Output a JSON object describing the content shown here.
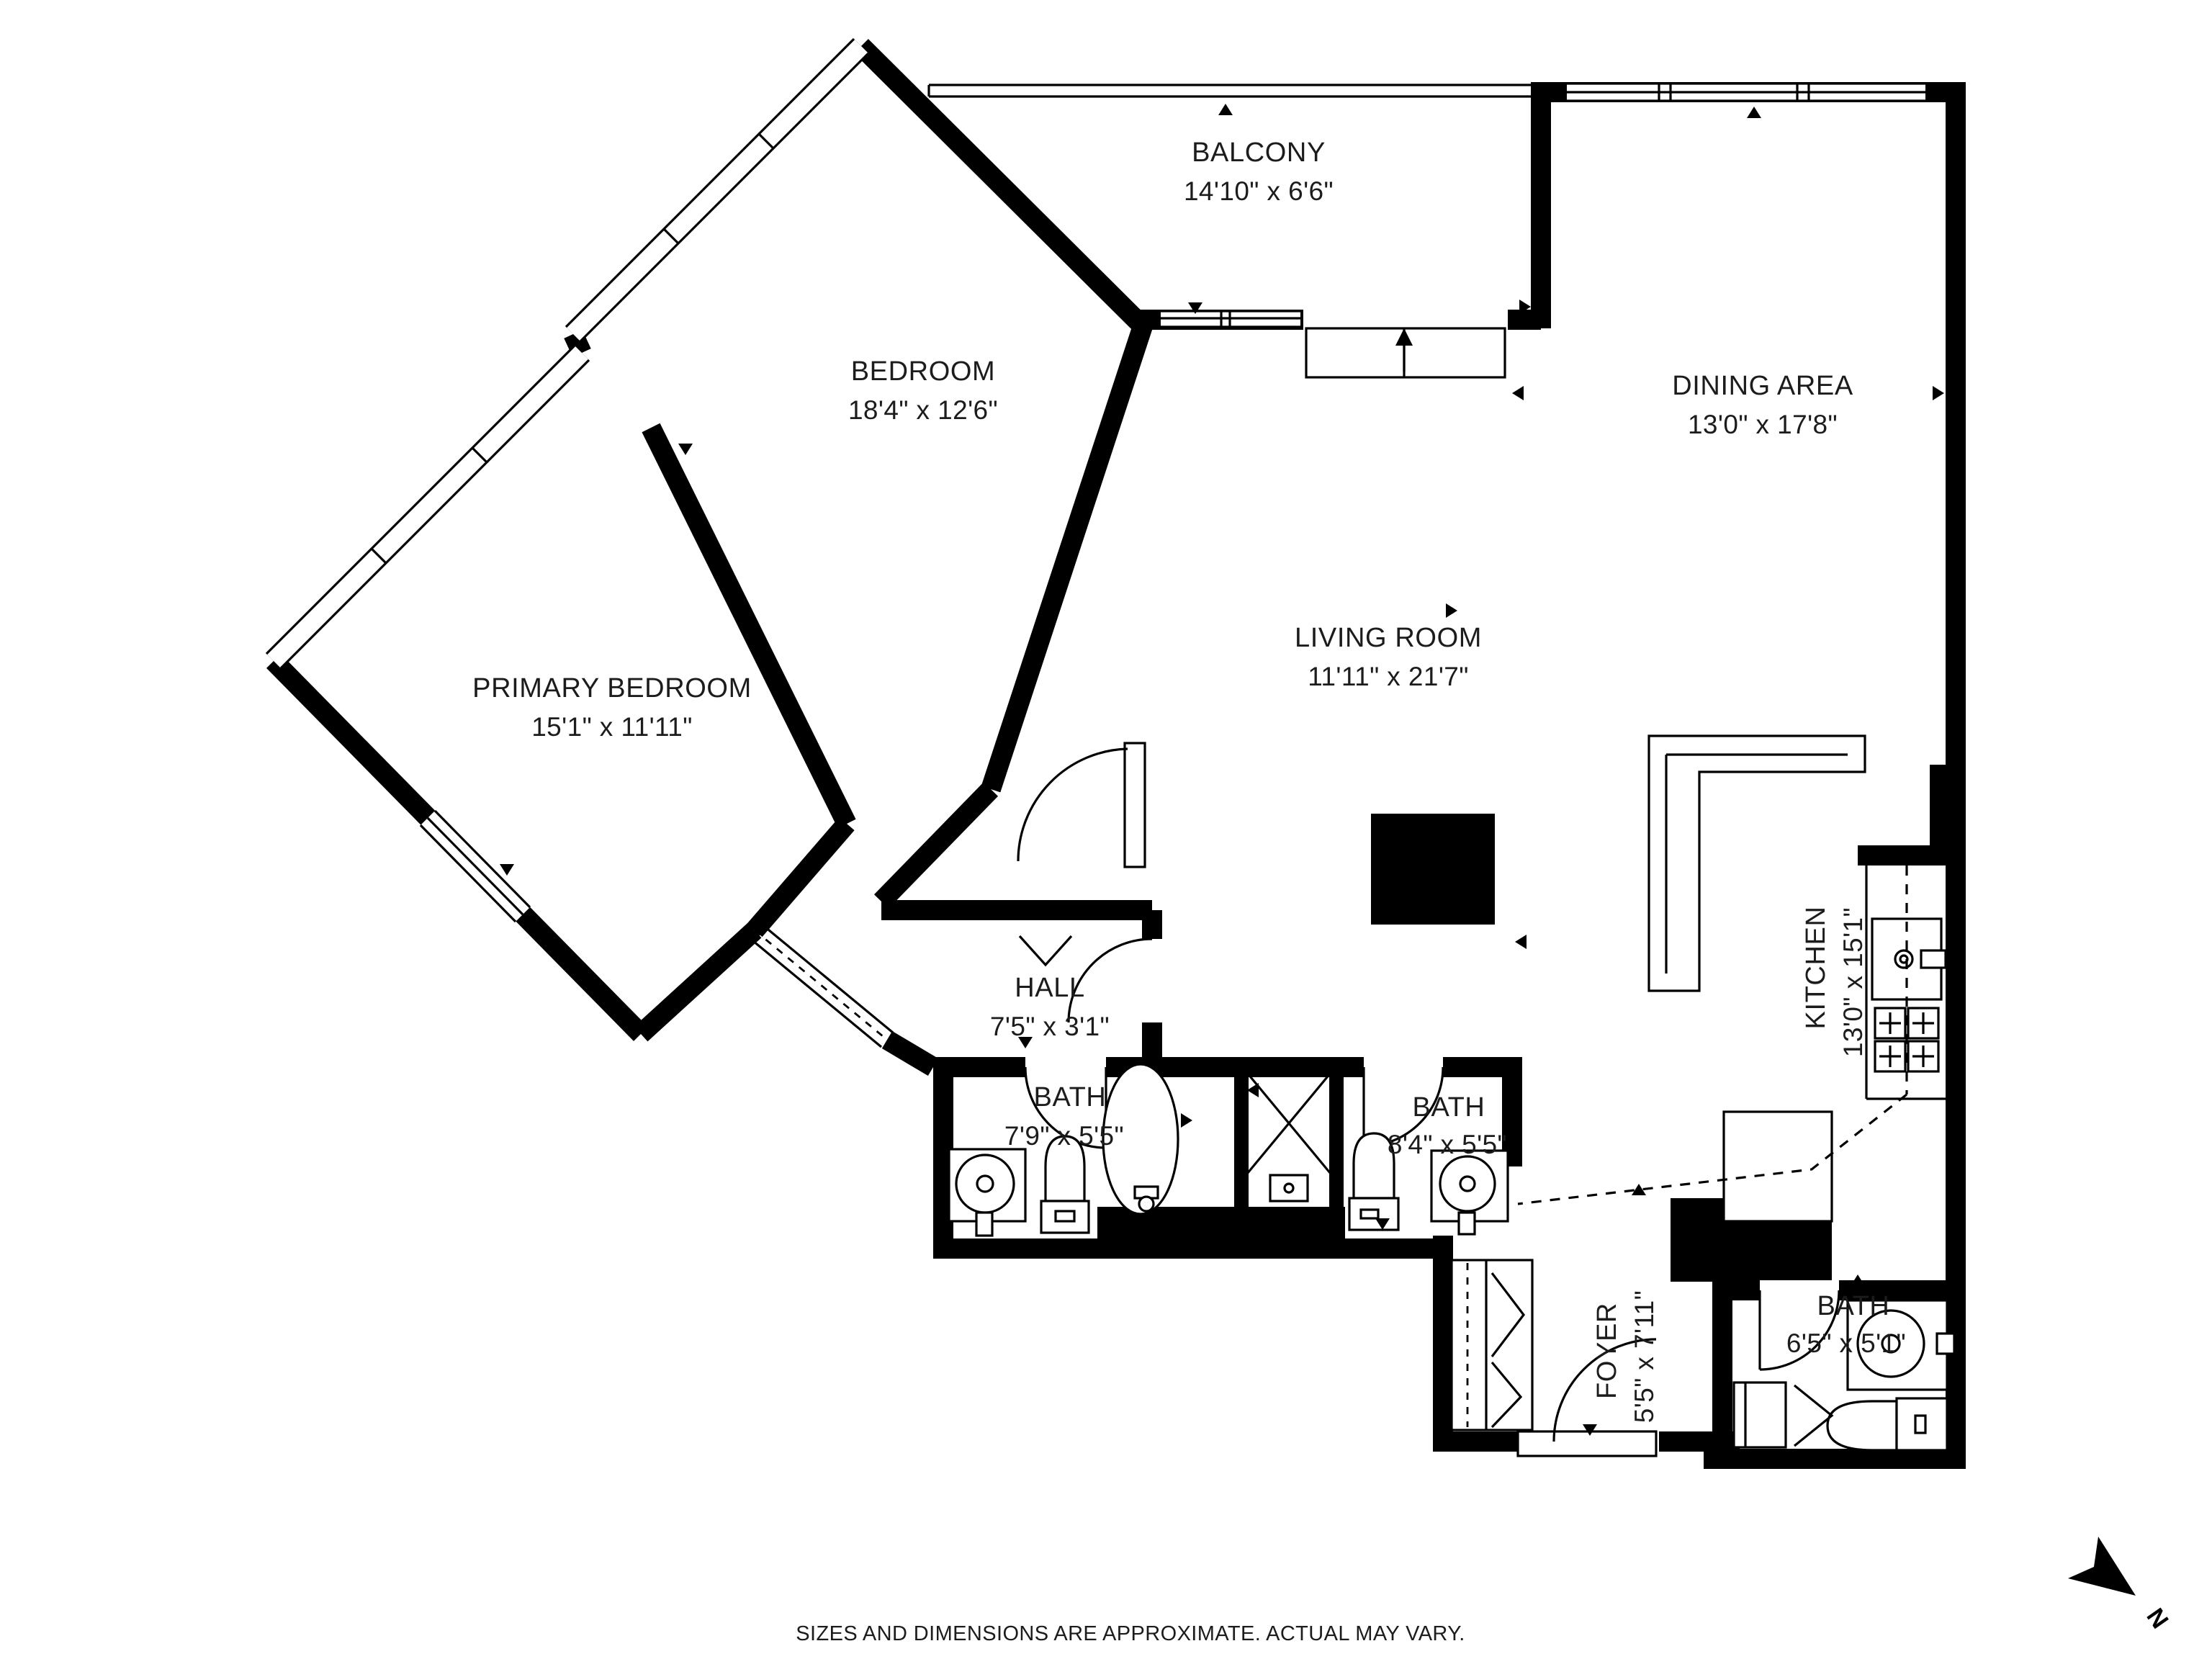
{
  "plan": {
    "rooms": {
      "balcony": {
        "name": "BALCONY",
        "dims": "14'10\" x 6'6\""
      },
      "bedroom": {
        "name": "BEDROOM",
        "dims": "18'4\" x 12'6\""
      },
      "dining": {
        "name": "DINING AREA",
        "dims": "13'0\" x 17'8\""
      },
      "primary": {
        "name": "PRIMARY BEDROOM",
        "dims": "15'1\" x 11'11\""
      },
      "living": {
        "name": "LIVING ROOM",
        "dims": "11'11\" x 21'7\""
      },
      "kitchen": {
        "name": "KITCHEN",
        "dims": "13'0\" x 15'1\""
      },
      "hall": {
        "name": "HALL",
        "dims": "7'5\" x 3'1\""
      },
      "bath1": {
        "name": "BATH",
        "dims": "7'9\" x 5'5\""
      },
      "bath2": {
        "name": "BATH",
        "dims": "8'4\" x 5'5\""
      },
      "foyer": {
        "name": "FOYER",
        "dims": "5'5\" x 7'11\""
      },
      "bath3": {
        "name": "BATH",
        "dims": "6'5\" x 5'1\""
      }
    },
    "footer": {
      "disclaimer": "SIZES AND DIMENSIONS ARE APPROXIMATE. ACTUAL MAY VARY."
    },
    "compass": {
      "label": "N"
    },
    "colors": {
      "wall": "#000000",
      "background": "#ffffff",
      "text": "#1c1c1c"
    }
  }
}
